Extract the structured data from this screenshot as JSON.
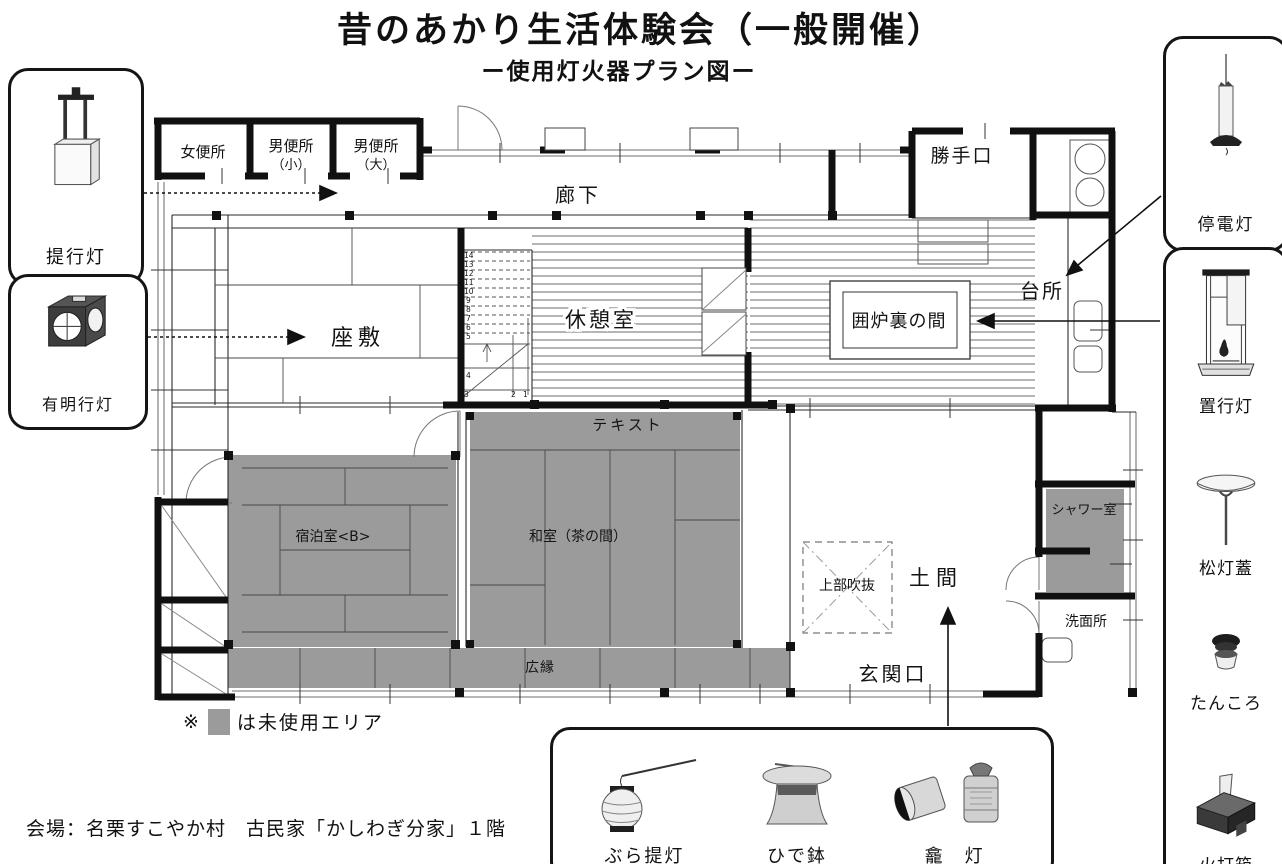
{
  "title": "昔のあかり生活体験会（一般開催）",
  "subtitle": "ー使用灯火器プラン図ー",
  "caption": "会場：名栗すこやか村　古民家「かしわぎ分家」１階",
  "legend": {
    "marker": "※",
    "label": "は未使用エリア"
  },
  "colors": {
    "unused_area": "#9b9b9b",
    "wall": "#111111"
  },
  "lamps": {
    "sage": "提行灯",
    "ariake": "有明行灯",
    "teiden": "停電灯",
    "oki": "置行灯",
    "shoto": "松灯蓋",
    "tankoro": "たんころ",
    "hiuchi": "火打箱",
    "bura": "ぶら提灯",
    "hide": "ひで鉢",
    "gando": "龕　灯"
  },
  "rooms": {
    "onna_benjo": "女便所",
    "otoko_benjo_sho": "男便所",
    "otoko_benjo_sho_sub": "（小）",
    "otoko_benjo_dai": "男便所",
    "otoko_benjo_dai_sub": "（大）",
    "roka": "廊下",
    "katteguchi": "勝手口",
    "daidokoro": "台所",
    "zashiki": "座敷",
    "kyukeishitsu": "休憩室",
    "irori_no_ma": "囲炉裏の間",
    "text_area": "テキスト",
    "shukuhaku_b": "宿泊室<B>",
    "washitsu": "和室（茶の間）",
    "shower": "シャワー室",
    "jobu_fukinuke": "上部吹抜",
    "doma": "土間",
    "senmenjo": "洗面所",
    "genkanguchi": "玄関口",
    "hiroen": "広縁"
  },
  "stairs": {
    "numbers": [
      "14",
      "13",
      "12",
      "11",
      "10",
      "9",
      "8",
      "7",
      "6",
      "5",
      "4",
      "3",
      "2",
      "1"
    ]
  }
}
